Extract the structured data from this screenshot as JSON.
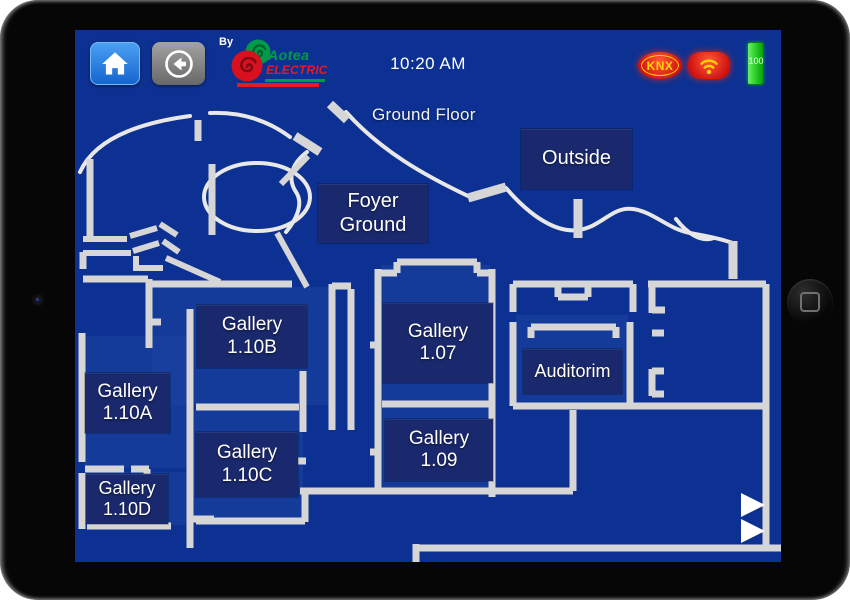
{
  "topbar": {
    "by_label": "By",
    "brand_name": "Aotea",
    "brand_sub": "ELECTRIC",
    "time": "10:20 AM",
    "knx_label": "KNX",
    "battery_level": "100"
  },
  "floorplan": {
    "title": "Ground Floor",
    "rooms": [
      {
        "name": "foyer-ground",
        "line1": "Foyer",
        "line2": "Ground"
      },
      {
        "name": "outside",
        "line1": "Outside",
        "line2": ""
      },
      {
        "name": "gallery-1-10b",
        "line1": "Gallery",
        "line2": "1.10B"
      },
      {
        "name": "gallery-1-10a",
        "line1": "Gallery",
        "line2": "1.10A"
      },
      {
        "name": "gallery-1-07",
        "line1": "Gallery",
        "line2": "1.07"
      },
      {
        "name": "auditorium",
        "line1": "Auditorim",
        "line2": ""
      },
      {
        "name": "gallery-1-10c",
        "line1": "Gallery",
        "line2": "1.10C"
      },
      {
        "name": "gallery-1-09",
        "line1": "Gallery",
        "line2": "1.09"
      },
      {
        "name": "gallery-1-10d",
        "line1": "Gallery",
        "line2": "1.10D"
      }
    ]
  },
  "icons": {
    "home": "house",
    "back": "arrow-left-in-circle",
    "knx": "knx-oval-badge",
    "wifi": "wifi-signal",
    "battery": "battery-vertical-full",
    "page_nav": "triangle-right"
  },
  "colors": {
    "screen-bg": "#0d3192",
    "room-fill": "#1c43a0",
    "label-box": "#1a296d",
    "wall": "#d6d6d6",
    "wall-thin": "#e8e8e8",
    "home-blue-top": "#4aa0f2",
    "home-blue-bottom": "#1565cf",
    "back-gray-top": "#a3a3a3",
    "back-gray-bottom": "#686868",
    "badge-red": "#cf1010",
    "badge-red-bright": "#ff5a36",
    "badge-yellow": "#ffd400",
    "battery-green": "#1fc61f",
    "brand-green": "#009a49",
    "brand-red": "#e51b24"
  }
}
